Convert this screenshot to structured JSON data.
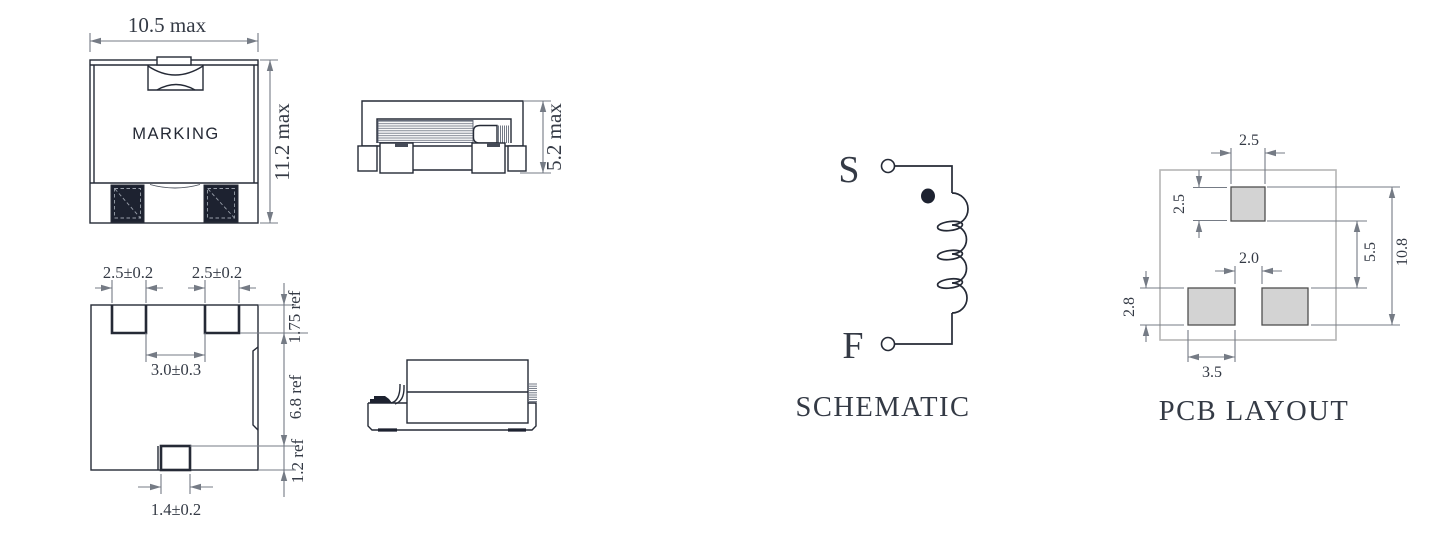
{
  "top_view": {
    "marking": "MARKING",
    "width": "10.5 max",
    "height": "11.2 max"
  },
  "side_view": {
    "height": "5.2 max"
  },
  "bottom_view": {
    "pad_width_left": "2.5±0.2",
    "pad_width_right": "2.5±0.2",
    "pad_gap": "3.0±0.3",
    "pad_depth": "1.75 ref",
    "body_length": "6.8 ref",
    "tab_height": "1.2 ref",
    "tab_width": "1.4±0.2"
  },
  "schematic": {
    "title": "SCHEMATIC",
    "terminal_start": "S",
    "terminal_finish": "F"
  },
  "pcb_layout": {
    "title": "PCB LAYOUT",
    "top_pad_width": "2.5",
    "top_pad_height": "2.5",
    "bottom_pad_gap": "2.0",
    "bottom_pad_height": "2.8",
    "pad_spacing": "5.5",
    "overall_height": "10.8",
    "bottom_pad_width": "3.5"
  },
  "colors": {
    "outline": "#252a36",
    "dimension": "#757b85",
    "text": "#343a45",
    "terminal_fill": "#1d2230",
    "pcb_pad_fill": "#d3d3d3",
    "pcb_pad_stroke": "#4f4f4f",
    "pcb_board_stroke": "#b6b6b6"
  }
}
